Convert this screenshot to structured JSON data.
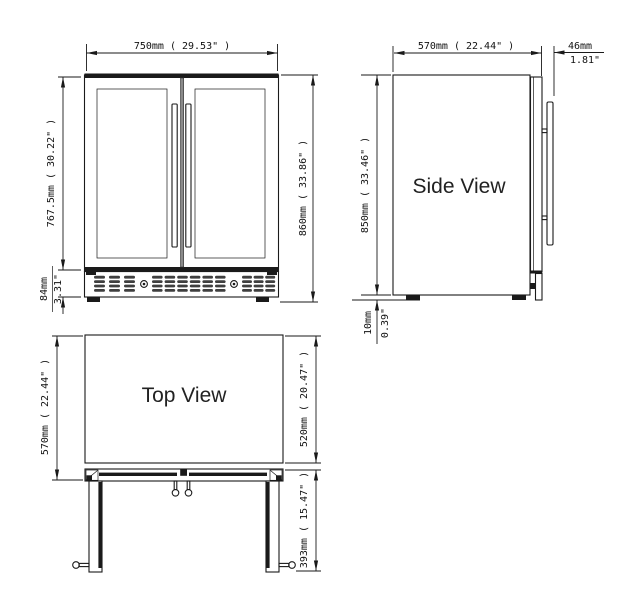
{
  "drawing": {
    "background": "#ffffff",
    "line_color": "#1a1a1a"
  },
  "views": {
    "front": {
      "dims": {
        "width": "750mm ( 29.53\" )",
        "door_height": "767.5mm ( 30.22\" )",
        "base_height_mm": "84mm",
        "base_height_in": "3.31\"",
        "total_height": "860mm ( 33.86\" )"
      }
    },
    "side": {
      "label": "Side View",
      "dims": {
        "depth": "570mm ( 22.44\" )",
        "handle_depth_mm": "46mm",
        "handle_depth_in": "1.81\"",
        "height": "850mm ( 33.46\" )",
        "foot_height_mm": "10mm",
        "foot_height_in": "0.39\""
      }
    },
    "top": {
      "label": "Top View",
      "dims": {
        "total_depth": "570mm ( 22.44\" )",
        "body_depth": "520mm ( 20.47\" )",
        "door_swing": "393mm ( 15.47\" )"
      }
    }
  }
}
